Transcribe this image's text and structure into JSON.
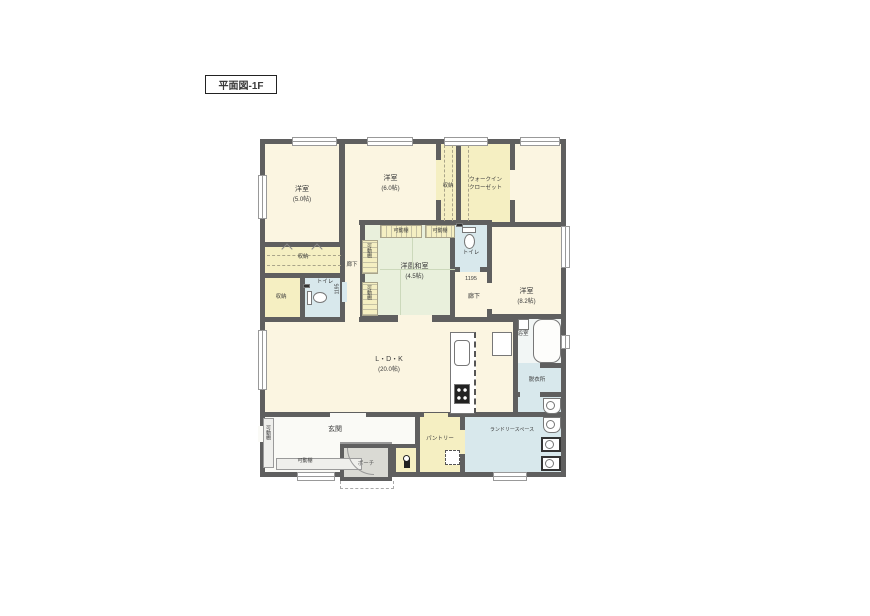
{
  "title": "平面図-1F",
  "rooms": {
    "yoshitsu5": {
      "label": "洋室",
      "size": "(5.0帖)"
    },
    "yoshitsu6": {
      "label": "洋室",
      "size": "(6.0帖)"
    },
    "shunou_col": {
      "label": "収納"
    },
    "wic": {
      "label1": "ウォークイン",
      "label2": "クローゼット"
    },
    "yoshitsu82": {
      "label": "洋室",
      "size": "(8.2帖)"
    },
    "washitsu": {
      "label": "洋風和室",
      "size": "(4.5帖)"
    },
    "toilet_upper": {
      "label": "トイレ"
    },
    "hall_right": {
      "label": "廊下"
    },
    "shunou_strip": {
      "label": "収納"
    },
    "shunou_small": {
      "label": "収納"
    },
    "toilet_left": {
      "label": "トイレ"
    },
    "hall_left": {
      "label": "廊下"
    },
    "ldk": {
      "label": "L・D・K",
      "size": "(20.0帖)"
    },
    "bath": {
      "label": "浴室"
    },
    "datsuijo": {
      "label": "脱衣所"
    },
    "laundry": {
      "label": "ランドリースペース"
    },
    "genkan": {
      "label": "玄関"
    },
    "porch": {
      "label": "ポーチ"
    },
    "pantry": {
      "label": "パントリー"
    }
  },
  "shelves": {
    "label": "可動棚"
  },
  "dimensions": {
    "left": "1195",
    "right": "1195"
  },
  "colors": {
    "wall": "#5f5f5f",
    "room_floor": "#fbf5e1",
    "storage": "#f5efc2",
    "wet_area": "#d8e8ec",
    "tatami": "#e9f0dc",
    "porch": "#dadad4"
  }
}
